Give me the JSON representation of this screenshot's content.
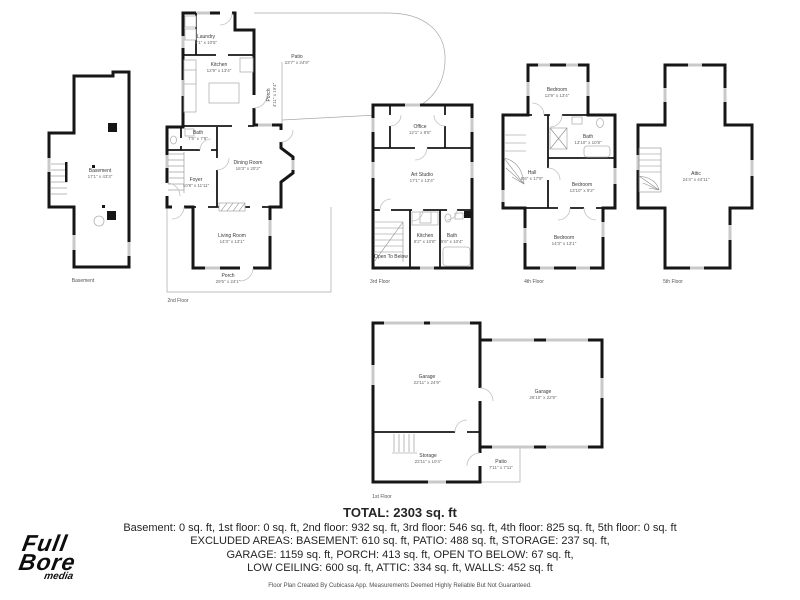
{
  "logo": {
    "line1": "Full",
    "line2": "Bore",
    "line3": "media"
  },
  "summary": {
    "total": "TOTAL: 2303 sq. ft",
    "line1": "Basement: 0 sq. ft, 1st floor: 0 sq. ft, 2nd floor: 932 sq. ft, 3rd floor: 546 sq. ft, 4th floor: 825 sq. ft, 5th floor: 0 sq. ft",
    "line2": "EXCLUDED AREAS: BASEMENT: 610 sq. ft, PATIO: 488 sq. ft, STORAGE: 237 sq. ft,",
    "line3": "GARAGE: 1159 sq. ft, PORCH: 413 sq. ft, OPEN TO BELOW: 67 sq. ft,",
    "line4": "LOW CEILING: 600 sq. ft, ATTIC: 334 sq. ft, WALLS: 452 sq. ft",
    "disclaimer": "Floor Plan Created By Cubicasa App. Measurements Deemed Highly Reliable But Not Guaranteed."
  },
  "floors": {
    "basement": {
      "label": "Basement",
      "rooms": {
        "basement": {
          "name": "Basement",
          "dims": "17'1\" x 43'3\""
        }
      }
    },
    "f2": {
      "label": "2nd Floor",
      "rooms": {
        "laundry": {
          "name": "Laundry",
          "dims": "8'1\" x 10'5\""
        },
        "kitchen": {
          "name": "Kitchen",
          "dims": "12'9\" x 13'4\""
        },
        "patio": {
          "name": "Patio",
          "dims": "23'7\" x 24'9\""
        },
        "porch_side": {
          "name": "Porch",
          "dims": "4'11\" x 19'4\""
        },
        "bath": {
          "name": "Bath",
          "dims": "7'5\" x 7'8\""
        },
        "dining": {
          "name": "Dining Room",
          "dims": "16'3\" x 20'2\""
        },
        "foyer": {
          "name": "Foyer",
          "dims": "10'8\" x 11'11\""
        },
        "living": {
          "name": "Living Room",
          "dims": "14'3\" x 13'1\""
        },
        "porch": {
          "name": "Porch",
          "dims": "29'5\" x 24'1\""
        }
      }
    },
    "f3": {
      "label": "3rd Floor",
      "rooms": {
        "office": {
          "name": "Office",
          "dims": "12'1\" x 8'5\""
        },
        "art_studio": {
          "name": "Art Studio",
          "dims": "17'1\" x 13'4\""
        },
        "kitchen": {
          "name": "Kitchen",
          "dims": "8'2\" x 10'8\""
        },
        "bath": {
          "name": "Bath",
          "dims": "5'6\" x 10'4\""
        },
        "open_below": {
          "name": "Open To Below"
        }
      }
    },
    "f4": {
      "label": "4th Floor",
      "rooms": {
        "bedroom_top": {
          "name": "Bedroom",
          "dims": "12'9\" x 13'4\""
        },
        "bath": {
          "name": "Bath",
          "dims": "13'10\" x 10'8\""
        },
        "hall": {
          "name": "Hall",
          "dims": "8'6\" x 17'9\""
        },
        "bedroom_mid": {
          "name": "Bedroom",
          "dims": "13'10\" x 9'2\""
        },
        "bedroom_bottom": {
          "name": "Bedroom",
          "dims": "14'3\" x 13'1\""
        }
      }
    },
    "f5": {
      "label": "5th Floor",
      "rooms": {
        "attic": {
          "name": "Attic",
          "dims": "24'4\" x 44'11\""
        }
      }
    },
    "f1": {
      "label": "1st Floor",
      "rooms": {
        "garage_left": {
          "name": "Garage",
          "dims": "22'11\" x 24'9\""
        },
        "garage_right": {
          "name": "Garage",
          "dims": "26'10\" x 22'9\""
        },
        "storage": {
          "name": "Storage",
          "dims": "22'11\" x 10'4\""
        },
        "patio": {
          "name": "Patio",
          "dims": "7'11\" x 7'11\""
        }
      }
    }
  }
}
